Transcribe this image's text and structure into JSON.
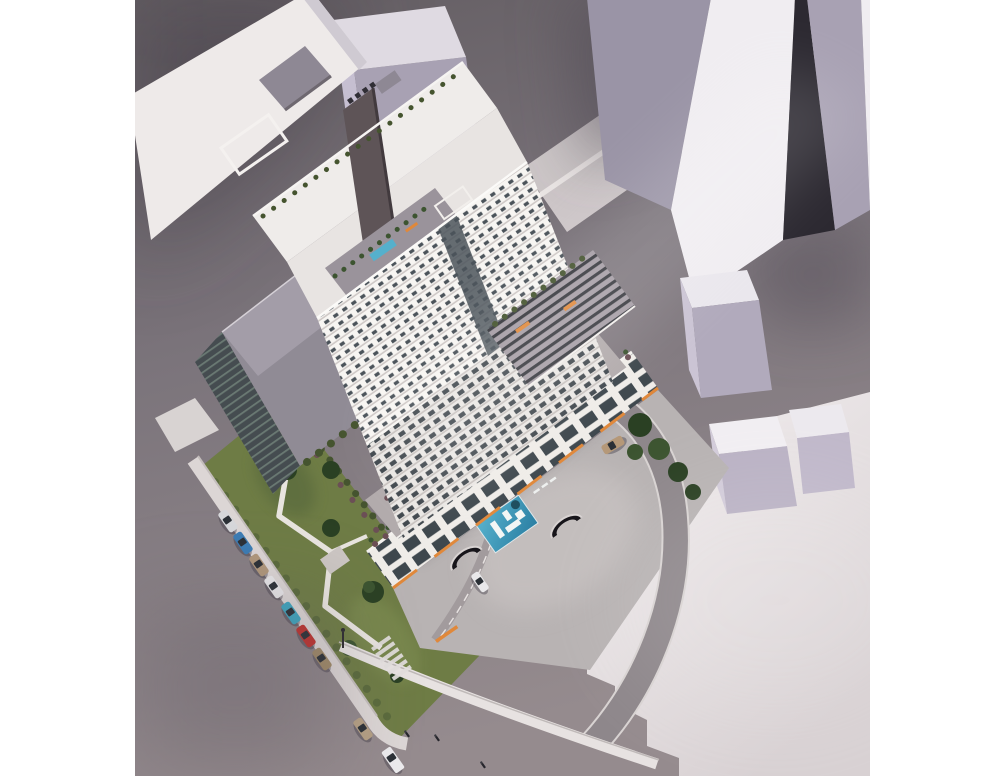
{
  "scene": {
    "type": "aerial-architectural-rendering",
    "subject": "white residential tower with podium courtyard pool, rooftop terraces, landscaped gardens, surrounding massing blocks, streets with parked cars"
  },
  "palette": {
    "page_bg": "#ffffff",
    "ground_top": "#635d62",
    "ground_mid": "#7b747b",
    "ground_bottom": "#958b8e",
    "rear_lane": "#d6cfd0",
    "sidewalk": "#dcd6d5",
    "curb_bright": "#e7e2e1",
    "curb_line": "#bfb9b8",
    "plaza_bright": "#f4f0f1",
    "plaza_dim": "#d8d1d3",
    "massing_top": "#dfdae2",
    "massing_left": "#c6bfd1",
    "massing_right": "#a8a1b3",
    "massing_bright": "#f0edf1",
    "massing_gap": "#2c2931",
    "slab_shade": "#9a94a6",
    "slab_lavender": "#cbc4d5",
    "roof_grey": "#908b95",
    "roof_grey_light": "#a39da8",
    "penthouse_grey": "#8e8894",
    "core_dark": "#5e5457",
    "north_bar": "#eeeae9",
    "tower_white": "#f7f5f2",
    "floor_line": "#cfc9c7",
    "window_dark": "#4b535a",
    "facade_lower_bg": "#eae7e4",
    "window_lower": "#41484e",
    "podium_face": "#efece8",
    "storefront_glass": "#3e474d",
    "glass_wall": "#454c50",
    "glass_mullion": "#6a7973",
    "pergola_bg": "#a49ca4",
    "pergola_slat": "#35363c",
    "terrace_deck": "#9a939b",
    "terrace_band": "#b2abac",
    "skylight_green": "#8fae9e",
    "skylight_frame": "#e4e7e1",
    "pool_light": "#55b0cc",
    "pool_deep": "#2b7fa3",
    "pool_deck_white": "#f3f6f5",
    "lap_pool": "#2e6f8e",
    "hot_tub": "#1d4d5e",
    "garden_base": "#6e7c45",
    "garden_dark": "#5a6a3c",
    "garden_light": "#7e8d51",
    "tree_dark": "#2a4023",
    "tree_mid": "#3c5430",
    "hedge": "#45542f",
    "shrub_purple": "#6b4f55",
    "orange_accent": "#e0883a",
    "path_white": "#e8e4df",
    "courtyard_paving": "#b8b3b3",
    "driveway_asphalt": "#8e878b",
    "ramp_void": "#17151a",
    "pedestrian": "#26262c",
    "car_glass": "#2b3036",
    "shadow_dark": "#3a3540"
  },
  "cars": {
    "left_street": [
      {
        "type": "car",
        "color": "#d7d8db"
      },
      {
        "type": "car",
        "color": "#3c7cb4"
      },
      {
        "type": "car",
        "color": "#b0977b"
      },
      {
        "type": "car",
        "color": "#e8e7e9"
      },
      {
        "type": "car",
        "color": "#3ea6c0"
      },
      {
        "type": "car",
        "color": "#c0322e"
      },
      {
        "type": "car",
        "color": "#a08a68"
      },
      {
        "type": "car",
        "color": "#b5a084"
      },
      {
        "type": "van",
        "color": "#ecebed"
      }
    ],
    "driveway": [
      {
        "type": "car",
        "color": "#b59878"
      },
      {
        "type": "car",
        "color": "#e9e8ea"
      }
    ]
  },
  "counts": {
    "parked_cars_left_street": 9,
    "driveway_cars": 2,
    "courtyard_skylights": 4,
    "crosswalk_stripes": 6,
    "pedestrians": 3,
    "neighbor_massing_blocks": 8,
    "garage_ramp_openings": 3
  }
}
